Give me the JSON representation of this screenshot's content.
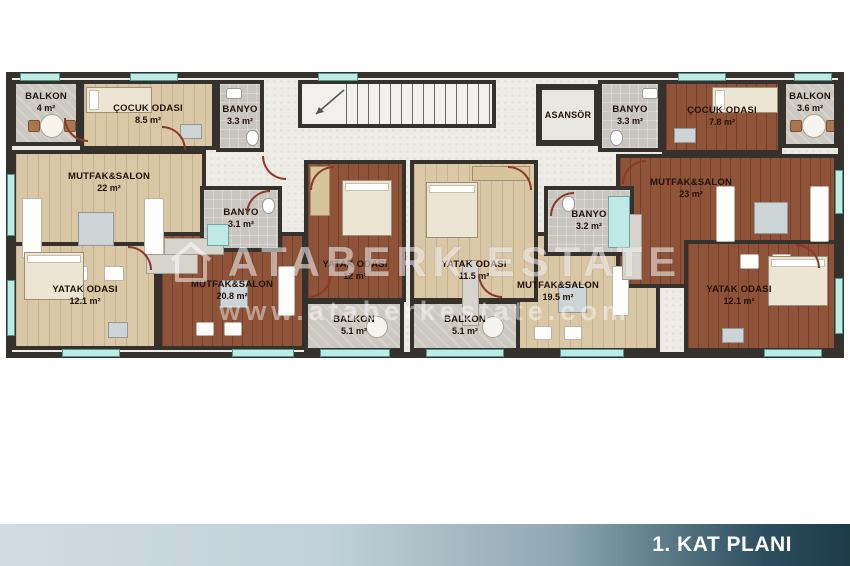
{
  "footer": {
    "title": "1. KAT PLANI"
  },
  "watermark": {
    "brand": "ATABERK ESTATE",
    "url": "www.ataberkestate.com"
  },
  "core": {
    "elevator_label": "ASANSÖR"
  },
  "colors": {
    "wall": "#35322e",
    "floor_light": "#d9c7a6",
    "floor_dark": "#8e5338",
    "floor_balcony": "#ccc9c2",
    "floor_bath": "#c9c6c0",
    "hallway": "#edebe6",
    "window": "#bdece7",
    "footer_light": "#cfdce1",
    "footer_dark": "#1b3b49",
    "label": "#221209"
  },
  "apartments": [
    {
      "id": "apartment-1",
      "rooms": [
        {
          "key": "balcony",
          "name": "BALKON",
          "area": "4 m²"
        },
        {
          "key": "kids-room",
          "name": "ÇOCUK ODASI",
          "area": "8.5 m²"
        },
        {
          "key": "bathroom-upper",
          "name": "BANYO",
          "area": "3.3 m²"
        },
        {
          "key": "living-kitchen",
          "name": "MUTFAK&SALON",
          "area": "22 m²"
        },
        {
          "key": "bathroom",
          "name": "BANYO",
          "area": "3.1 m²"
        },
        {
          "key": "bedroom",
          "name": "YATAK ODASI",
          "area": "12.1 m²"
        }
      ]
    },
    {
      "id": "apartment-2",
      "rooms": [
        {
          "key": "bedroom",
          "name": "YATAK ODASI",
          "area": "12 m²"
        },
        {
          "key": "living-kitchen",
          "name": "MUTFAK&SALON",
          "area": "20.8 m²"
        },
        {
          "key": "balcony",
          "name": "BALKON",
          "area": "5.1 m²"
        }
      ]
    },
    {
      "id": "apartment-3",
      "rooms": [
        {
          "key": "bedroom",
          "name": "YATAK ODASI",
          "area": "11.5 m²"
        },
        {
          "key": "bathroom",
          "name": "BANYO",
          "area": "3.2 m²"
        },
        {
          "key": "living-kitchen",
          "name": "MUTFAK&SALON",
          "area": "19.5 m²"
        },
        {
          "key": "balcony",
          "name": "BALKON",
          "area": "5.1 m²"
        }
      ]
    },
    {
      "id": "apartment-4",
      "rooms": [
        {
          "key": "bathroom-upper",
          "name": "BANYO",
          "area": "3.3 m²"
        },
        {
          "key": "kids-room",
          "name": "ÇOCUK ODASI",
          "area": "7.8 m²"
        },
        {
          "key": "balcony-upper",
          "name": "BALKON",
          "area": "3.6 m²"
        },
        {
          "key": "living-kitchen",
          "name": "MUTFAK&SALON",
          "area": "23 m²"
        },
        {
          "key": "bedroom",
          "name": "YATAK ODASI",
          "area": "12.1 m²"
        }
      ]
    }
  ]
}
